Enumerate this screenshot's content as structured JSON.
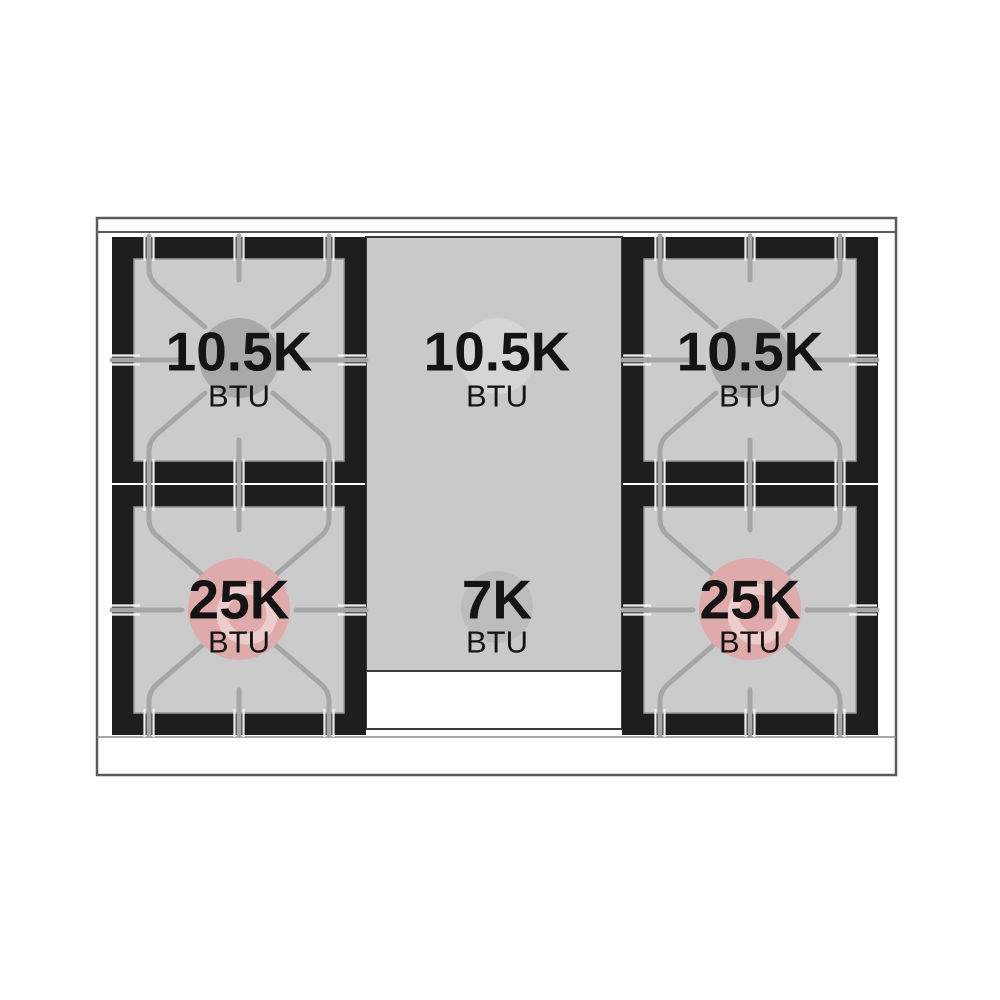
{
  "diagram": {
    "title": "gas-range-cooktop-burner-layout",
    "burners": [
      {
        "id": "top-left",
        "value": "10.5K",
        "unit": "BTU"
      },
      {
        "id": "top-center",
        "value": "10.5K",
        "unit": "BTU"
      },
      {
        "id": "top-right",
        "value": "10.5K",
        "unit": "BTU"
      },
      {
        "id": "bottom-left",
        "value": "25K",
        "unit": "BTU"
      },
      {
        "id": "bottom-center",
        "value": "7K",
        "unit": "BTU"
      },
      {
        "id": "bottom-right",
        "value": "25K",
        "unit": "BTU"
      }
    ],
    "colors": {
      "frame": "#1e1e1e",
      "surface": "#cbcbcb",
      "panel": "#c9c9c9",
      "grate": "#a6a6a6",
      "grate_highlight": "#f2f2f2",
      "cap_gray": "#a9a9a9",
      "cap_light": "#d5d5d5",
      "cap_mid": "#bcbcbc",
      "cap_pink": "#dfaaaa",
      "cap_pink_light": "#edcccc",
      "outline": "#5a5a5a",
      "inner_border": "#9a9a9a",
      "panel_border": "#3c3c3c",
      "text": "#141414",
      "bg": "#ffffff"
    }
  }
}
